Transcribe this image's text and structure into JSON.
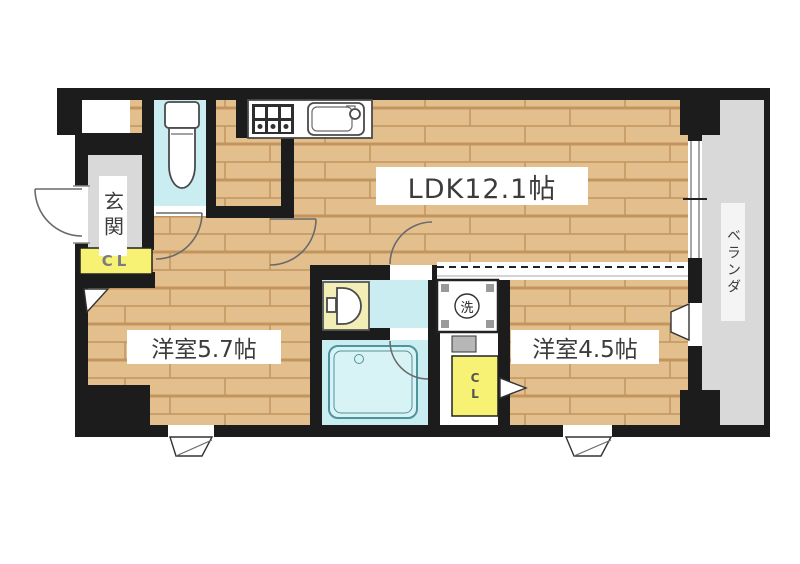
{
  "plan": {
    "labels": {
      "ldk": "LDK12.1帖",
      "room_57": "洋室5.7帖",
      "room_45": "洋室4.5帖",
      "entrance": "玄関",
      "veranda": "ベランダ",
      "closet_entrance": "CL",
      "closet_room45": "CL",
      "washer": "洗"
    },
    "colors": {
      "wall": "#1c1c1c",
      "page": "#ffffff",
      "wood": "#e4bf8e",
      "wood_line": "#c2955f",
      "water": "#c9edf1",
      "water_light": "#d8f3f5",
      "gray_floor": "#d9d9d9",
      "yellow": "#f7f174",
      "cream": "#f3eeb6",
      "text": "#3c3c3c"
    }
  }
}
